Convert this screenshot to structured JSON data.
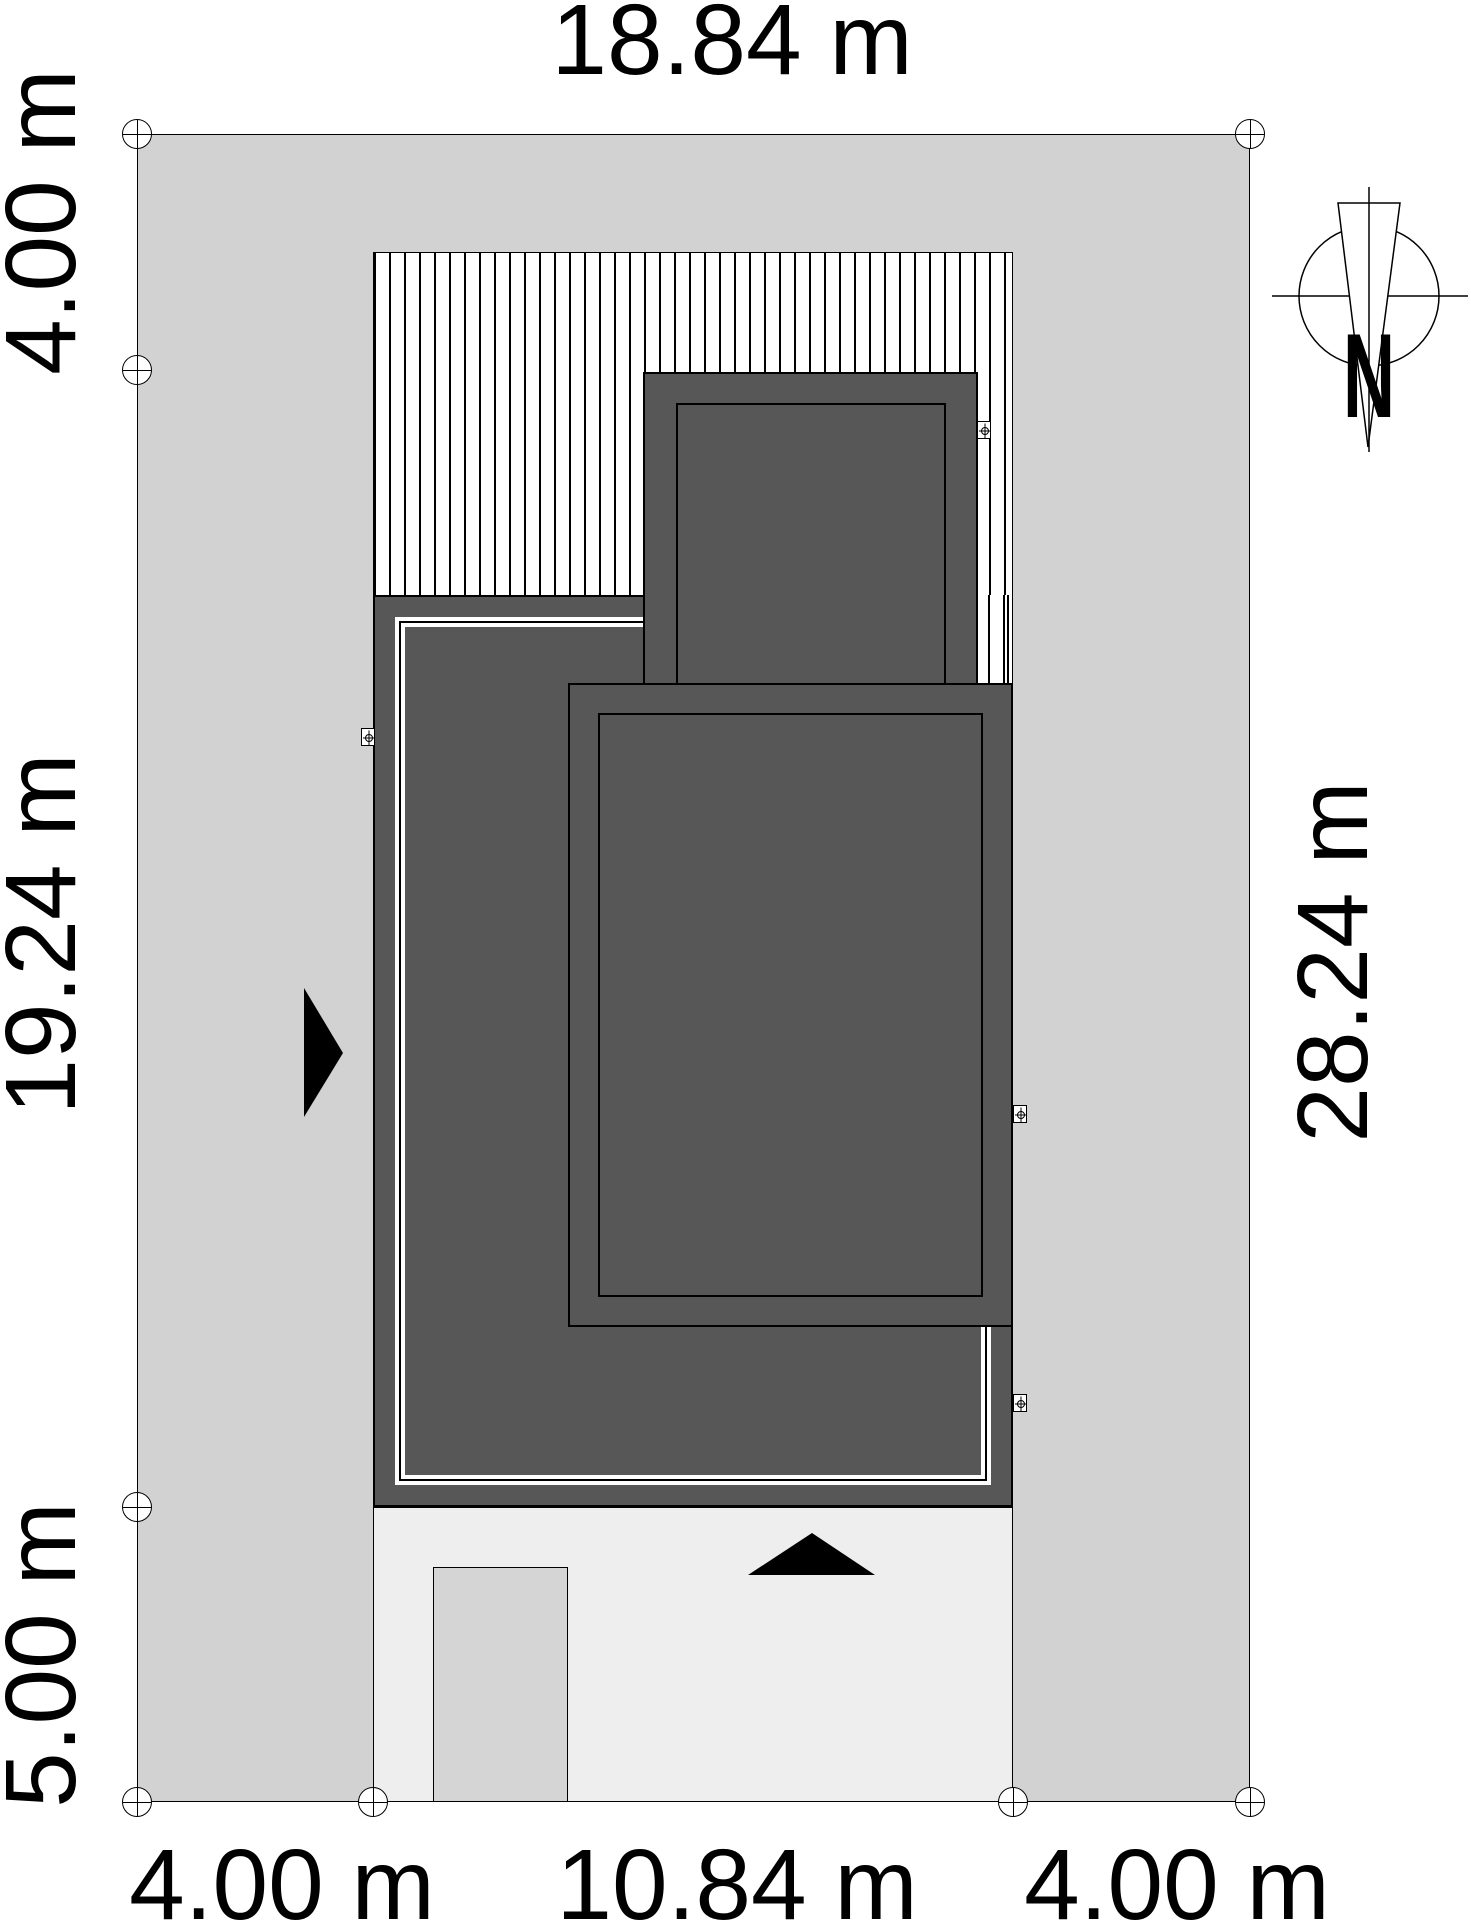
{
  "site_plan": {
    "dimensions": {
      "top": "18.84 m",
      "right": "28.24 m",
      "left": [
        "4.00 m",
        "19.24 m",
        "5.00 m"
      ],
      "bottom": [
        "4.00 m",
        "10.84 m",
        "4.00 m"
      ]
    },
    "compass": {
      "north_label": "N"
    },
    "colors": {
      "plot": "#d2d2d2",
      "building": "#575757",
      "driveway": "#eeeeee",
      "walkway": "#d5d5d5",
      "outline": "#000000",
      "hatch_background": "#ffffff"
    }
  }
}
